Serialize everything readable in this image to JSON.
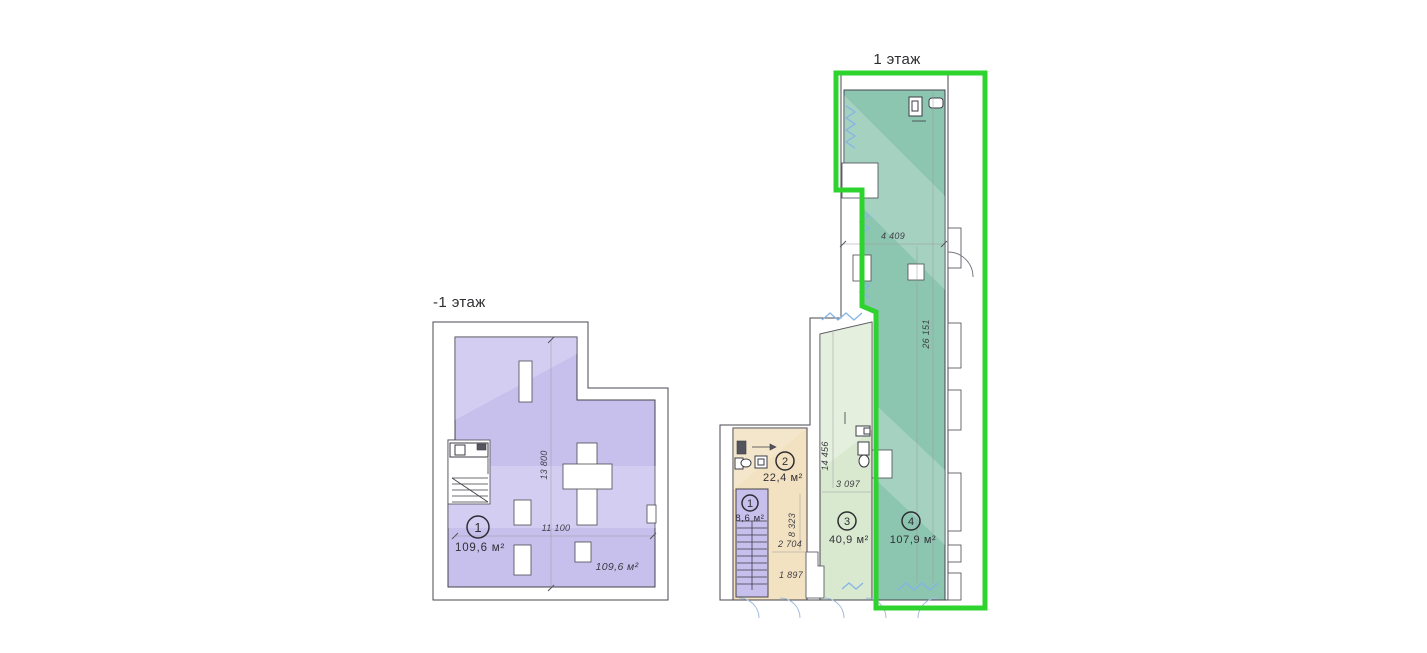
{
  "page": {
    "background": "#ffffff"
  },
  "colors": {
    "highlight_outline": "#2ed32e",
    "zone_teal": "#8cc5b0",
    "zone_light_green": "#d9e9d0",
    "zone_beige": "#f3e2c1",
    "zone_purple": "#c7c0ed",
    "wall_line": "#4a4a52",
    "window_blue": "#85b4e6",
    "dim_text": "#3f3f44"
  },
  "floor_minus1": {
    "title": "-1 этаж",
    "unit": {
      "number": "1",
      "area": "109,6 м²"
    },
    "area_note": "109,6 м²",
    "dim_width": "11 100",
    "dim_height": "13 800"
  },
  "floor_1": {
    "title": "1 этаж",
    "units": [
      {
        "number": "1",
        "area": "8,6 м²"
      },
      {
        "number": "2",
        "area": "22,4 м²"
      },
      {
        "number": "3",
        "area": "40,9 м²"
      },
      {
        "number": "4",
        "area": "107,9 м²"
      }
    ],
    "dims": {
      "top_width": "4 409",
      "right_height": "26 151",
      "mid_height": "14 456",
      "mid_width": "3 097",
      "low_height": "8 323",
      "low_width": "2 704",
      "bottom_width": "1 897"
    }
  }
}
